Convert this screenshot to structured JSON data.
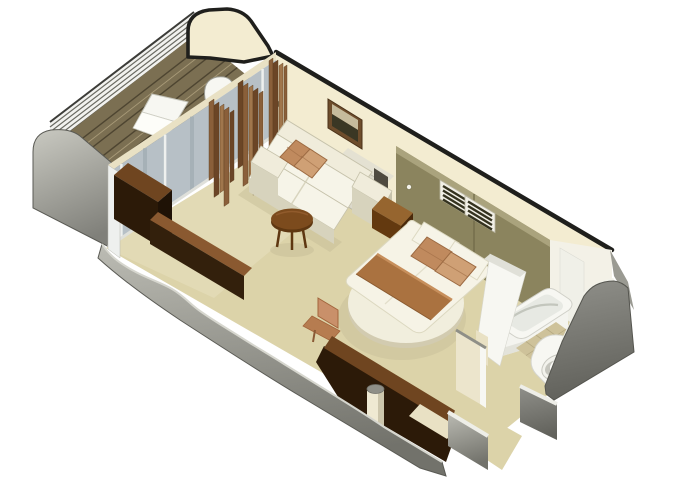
{
  "meta": {
    "kind": "isometric-3d-floorplan",
    "subject": "cruise-ship balcony stateroom cutaway rendering",
    "canvas": {
      "width": 680,
      "height": 486
    }
  },
  "scene": {
    "view": "isometric cutaway, walls cut low, no text labels",
    "rooms": [
      {
        "name": "balcony",
        "items": [
          "wood-plank-deck",
          "lounge-cushion",
          "railing",
          "partition-wall",
          "partition-door",
          "sliding-glass-door",
          "curtains"
        ]
      },
      {
        "name": "living-area",
        "items": [
          "sofa",
          "accent-pillows",
          "coffee-table",
          "wall-art",
          "tv-console",
          "side-cabinet",
          "tv-screen",
          "desk-chair"
        ]
      },
      {
        "name": "sleeping-area",
        "items": [
          "round-platform-bed",
          "mattress",
          "blanket-band",
          "bed-pillows",
          "nightstand",
          "headboard-panel",
          "louvered-vents",
          "panel-knob"
        ]
      },
      {
        "name": "bathroom",
        "items": [
          "bathtub",
          "toilet",
          "tiled-floor",
          "partition-walls"
        ]
      },
      {
        "name": "entry",
        "items": [
          "open-wardrobe",
          "shelf-board",
          "support-column",
          "corridor",
          "cut-gray-walls"
        ]
      }
    ]
  },
  "colors": {
    "background": "#ffffff",
    "outline": "#1f1f1c",
    "wall-cream": "#f3ecd1",
    "wall-cream-shade": "#e9e1c4",
    "floor": "#dcd3a9",
    "floor-light": "#e8e0bf",
    "floor-shade": "#c6bd97",
    "gray-wall": "#9a9a92",
    "gray-wall-light": "#bcbcb4",
    "gray-wall-dark": "#72726b",
    "gray-corner-light": "#c9c9c1",
    "gray-corner-dark": "#80807a",
    "gray-right-light": "#90908a",
    "gray-right-dark": "#62625c",
    "white-cap": "#eeeee8",
    "khaki-panel": "#8b845e",
    "khaki-panel-light": "#aaa37d",
    "khaki-panel-dark": "#6e6846",
    "vent-frame": "#f1efe6",
    "vent-slat": "#34321f",
    "glass": "#b7c0c6",
    "glass-streak": "#96a3aa",
    "glass-frame": "#eef0ee",
    "curtain": "#8a5f3a",
    "curtain-dark": "#6b4526",
    "curtain-light": "#a0764c",
    "deck": "#7b6f52",
    "deck-stripe": "#4e4531",
    "deck-light": "#a89a78",
    "railing": "#f2f2ef",
    "railing-line": "#6a6a62",
    "sofa-cream": "#f0ecdb",
    "sofa-cushion": "#f6f4e8",
    "sofa-shade": "#d7d3bd",
    "sofa-edge": "#c6c2ab",
    "pillow": "#c08a5e",
    "pillow-dark": "#9c6a42",
    "pillow-light": "#cfa075",
    "wood-dark": "#2c1a08",
    "wood-mid": "#6f4520",
    "wood-brown": "#7c4b1d",
    "wood-deep": "#5e3711",
    "wood-tan": "#c9906a",
    "blanket": "#aa7240",
    "blanket-light": "#c78f5c",
    "mattress": "#f6f3e6",
    "nightstand-top": "#96652f",
    "nightstand-front": "#63390f",
    "nightstand-side": "#4a290a",
    "fixture-white": "#f7f7f2",
    "fixture-shadow": "#d9d9d1",
    "basin": "#e7e9e3",
    "tile": "#cec29a",
    "tile-grid": "#b2a67e",
    "column": "#efe9d2",
    "column-shade": "#cdc6ac",
    "cap-gray": "#8f8f87",
    "frame-brown": "#6e4d2c",
    "art-light": "#c6bb9c",
    "art-dark": "#3a3724",
    "tv": "#4e4a40",
    "cabinet-gray": "#dbd8ca"
  }
}
